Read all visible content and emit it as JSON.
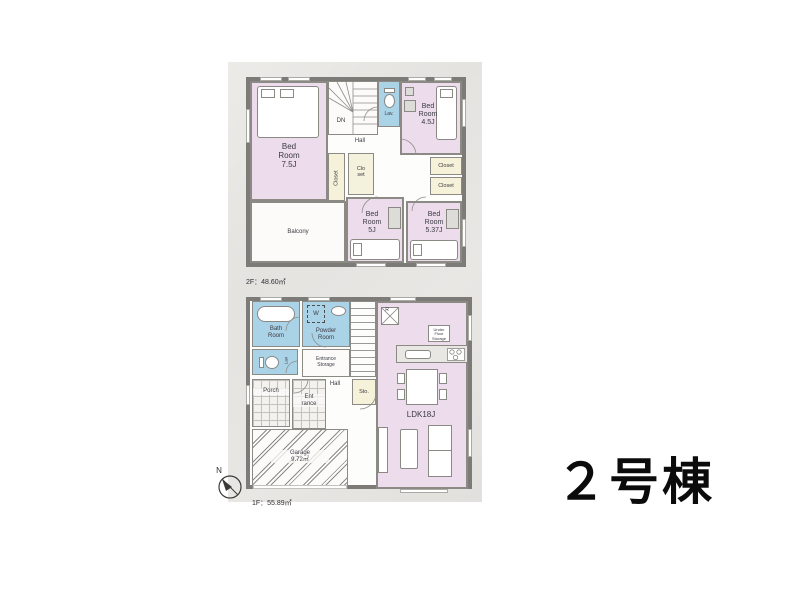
{
  "building": {
    "title": "２号棟"
  },
  "floor2": {
    "area_line1": "2F：48.60㎡",
    "area_line2": "（ルーフバルコニー面積9.72㎡）",
    "rooms": {
      "bedroom75": "Bed\nRoom\n7.5J",
      "bedroom45": "Bed\nRoom\n4.5J",
      "bedroom5": "Bed\nRoom\n5J",
      "bedroom537": "Bed\nRoom\n5.37J",
      "hall": "Hall",
      "dn": "DN",
      "lav": "Lav.",
      "closet_vertical": "Closet",
      "closet_small": "Clo\nset",
      "closet_right_1": "Closet",
      "closet_right_2": "Closet",
      "balcony": "Balcony"
    }
  },
  "floor1": {
    "area_line": "1F：55.89㎡",
    "rooms": {
      "bath": "Bath\nRoom",
      "washer": "W",
      "powder": "Powder\nRoom",
      "lav": "Lav",
      "entrance_storage": "Entrance\nStorage",
      "up": "UP",
      "hall": "Hall",
      "storage": "Sto.",
      "porch": "Porch",
      "entrance": "Ent\nrance",
      "garage": "Garage\n9.72㎡",
      "ldk": "LDK18J",
      "fridge": "R",
      "under_floor_storage": "Under\nFloor\nStorage"
    }
  },
  "compass": {
    "north": "N"
  },
  "colors": {
    "room_pink": "#ecdcec",
    "wet_area_blue": "#abd3e7",
    "closet_yellow": "#f6f2d9",
    "wall_gray": "#7c7b77",
    "paper_gray": "#e7e5e2",
    "title_black": "#0b0b0b"
  }
}
